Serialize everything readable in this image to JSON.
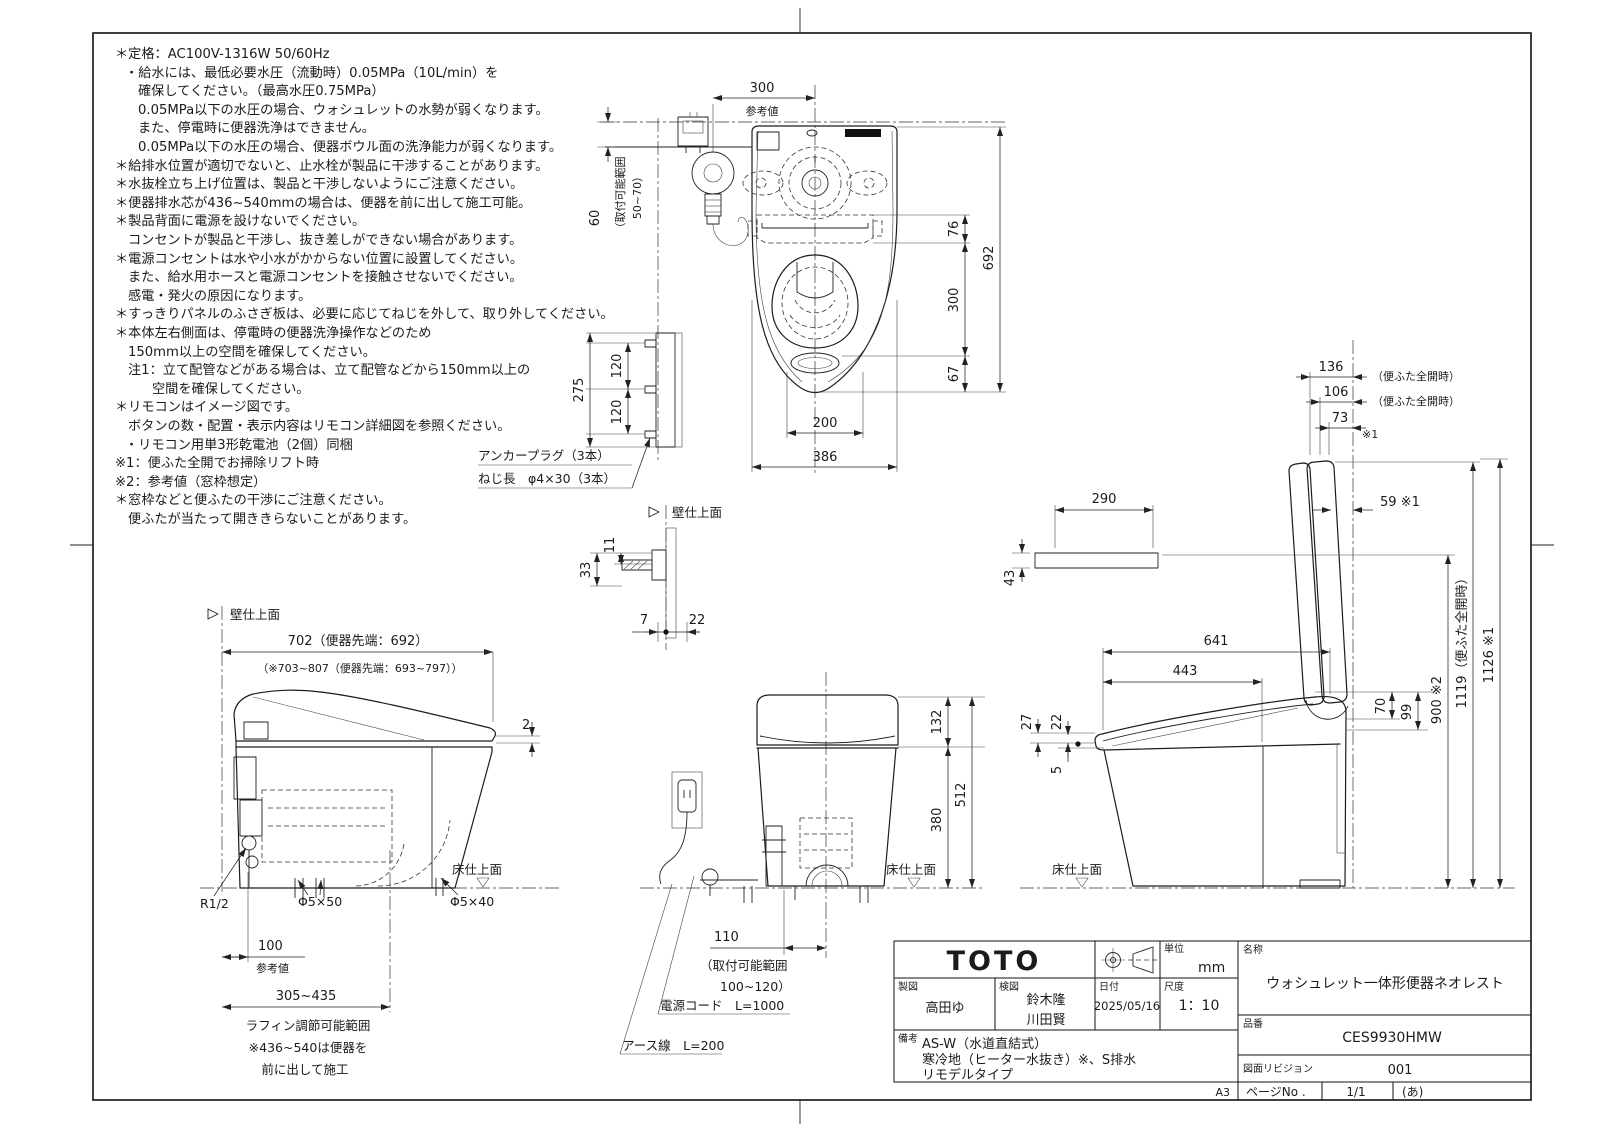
{
  "sheet": {
    "paper": "A3",
    "page_label": "ページNo .",
    "page": "1/1",
    "page_note": "(あ)"
  },
  "notes": {
    "lines": [
      "＊定格：AC100V-1316W 50/60Hz",
      "・給水には、最低必要水圧（流動時）0.05MPa（10L/min）を",
      "確保してください。（最高水圧0.75MPa）",
      "0.05MPa以下の水圧の場合、ウォシュレットの水勢が弱くなります。",
      "また、停電時に便器洗浄はできません。",
      "0.05MPa以下の水圧の場合、便器ボウル面の洗浄能力が弱くなります。",
      "＊給排水位置が適切でないと、止水栓が製品に干渉することがあります。",
      "＊水抜栓立ち上げ位置は、製品と干渉しないようにご注意ください。",
      "＊便器排水芯が436~540mmの場合は、便器を前に出して施工可能。",
      "＊製品背面に電源を設けないでください。",
      "コンセントが製品と干渉し、抜き差しができない場合があります。",
      "＊電源コンセントは水や小水がかからない位置に設置してください。",
      "また、給水用ホースと電源コンセントを接触させないでください。",
      "感電・発火の原因になります。",
      "＊すっきりパネルのふさぎ板は、必要に応じてねじを外して、取り外してください。",
      "＊本体左右側面は、停電時の便器洗浄操作などのため",
      "150mm以上の空間を確保してください。",
      "注1：立て配管などがある場合は、立て配管などから150mm以上の",
      "空間を確保してください。",
      "＊リモコンはイメージ図です。",
      "ボタンの数・配置・表示内容はリモコン詳細図を参照ください。",
      "・リモコン用単3形乾電池（2個）同梱",
      "※1：便ふた全開でお掃除リフト時",
      "※2：参考値（窓枠想定）",
      "＊窓枠などと便ふたの干渉にご注意ください。",
      "便ふたが当たって開ききらないことがあります。"
    ]
  },
  "plan": {
    "d300": "300",
    "ref": "参考値",
    "d60": "60",
    "range1": "（取付可能範囲",
    "range2": "50~70）",
    "d76": "76",
    "d692": "692",
    "d300b": "300",
    "d67": "67",
    "d200": "200",
    "d386": "386",
    "d275": "275",
    "d120a": "120",
    "d120b": "120",
    "anchor1": "アンカープラグ（3本）",
    "anchor2": "ねじ長　φ4×30（3本）"
  },
  "wall_detail": {
    "label": "壁仕上面",
    "d33": "33",
    "d11": "11",
    "d7": "7",
    "d22": "22"
  },
  "left_view": {
    "wall": "壁仕上面",
    "floor": "床仕上面",
    "d702": "702（便器先端：692）",
    "d702b": "（※703~807（便器先端：693~797））",
    "d2": "2",
    "r12": "R1/2",
    "s50": "Φ5×50",
    "s40": "Φ5×40",
    "d100": "100",
    "ref": "参考値",
    "range": "305~435",
    "note1": "ラフィン調節可能範囲",
    "note2": "※436~540は便器を",
    "note3": "前に出して施工"
  },
  "front_view": {
    "d132": "132",
    "d380": "380",
    "d512": "512",
    "floor": "床仕上面",
    "d110": "110",
    "range1": "（取付可能範囲",
    "range2": "100~120）",
    "cord": "電源コード　L=1000",
    "earth": "アース線　L=200"
  },
  "right_view": {
    "d136": "136",
    "open1": "（便ふた全開時）",
    "d106": "106",
    "open2": "（便ふた全開時）",
    "d73": "73",
    "n73": "※1",
    "d59": "59 ※1",
    "d290": "290",
    "d43": "43",
    "d641": "641",
    "d443": "443",
    "d27": "27",
    "d22": "22",
    "d5": "5",
    "d70": "70",
    "d99": "99",
    "d900": "900 ※2",
    "d1119": "1119（便ふた全開時）",
    "d1126": "1126 ※1",
    "floor": "床仕上面"
  },
  "title_block": {
    "logo": "TOTO",
    "unit_label": "単位",
    "unit_value": "mm",
    "drawn_label": "製図",
    "drawn_value": "高田ゆ",
    "checked_label": "検図",
    "checked_values": [
      "鈴木隆",
      "川田賢"
    ],
    "date_label": "日付",
    "date_value": "2025/05/16",
    "scale_label": "尺度",
    "scale_value": "1：10",
    "name_label": "名称",
    "name_value": "ウォシュレット一体形便器ネオレスト",
    "part_label": "品番",
    "part_value": "CES9930HMW",
    "revision_label": "図面リビジョン",
    "revision_value": "001",
    "remarks_label": "備考",
    "remarks_lines": [
      "AS-W（水道直結式）",
      "寒冷地（ヒーター水抜き）※、S排水",
      "リモデルタイプ"
    ]
  }
}
